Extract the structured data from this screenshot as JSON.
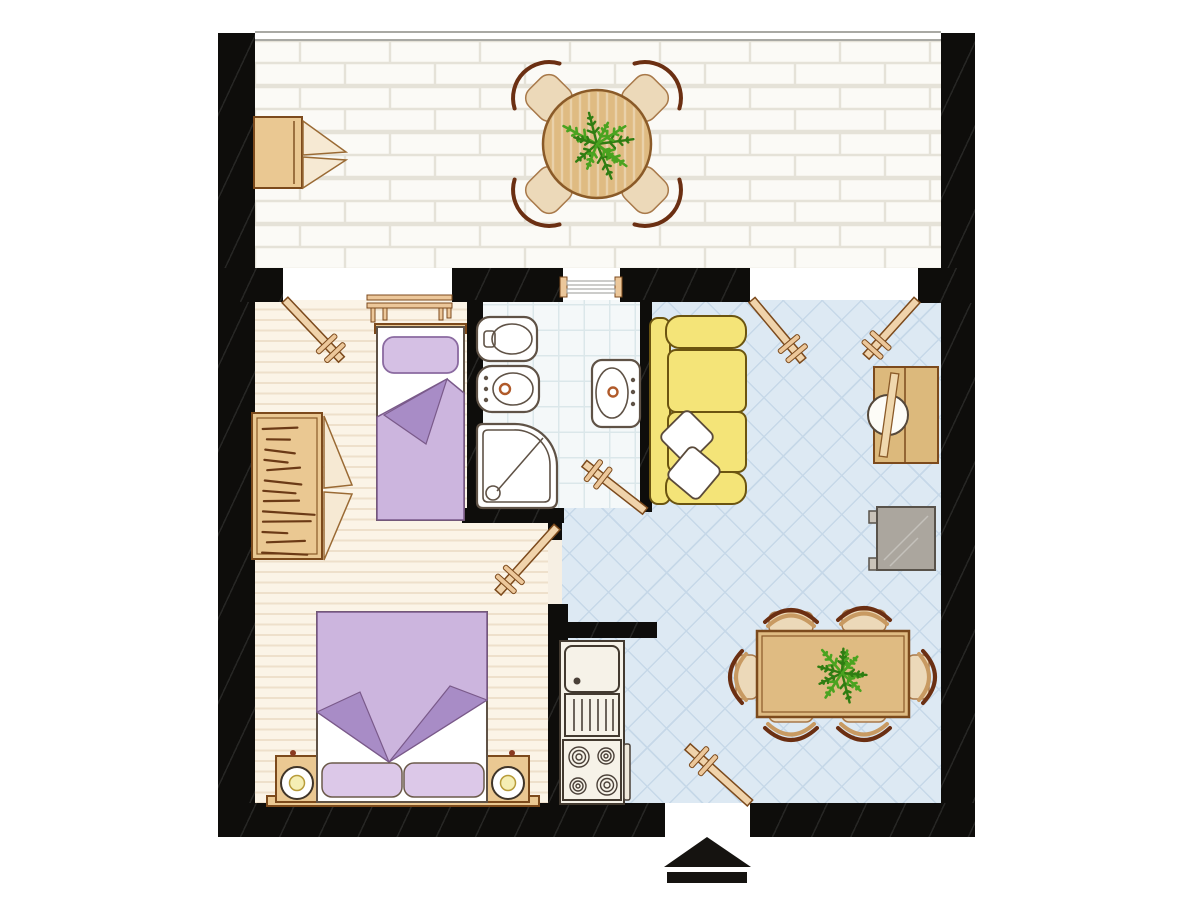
{
  "canvas": {
    "width": 1200,
    "height": 900
  },
  "diagram_type": "apartment-floor-plan",
  "colors": {
    "wall": "#0e0d0b",
    "terrace-floor": "#fbfaf6",
    "terrace-line": "#e5e2d8",
    "bedroom-floor": "#fbf4e7",
    "bedroom-stripe": "#eee0cb",
    "bath-floor": "#f4f8f9",
    "bath-line": "#dbe7ea",
    "living-floor": "#dde9f3",
    "living-line": "#c6d8e8",
    "wood": "#eac892",
    "wood-dark": "#7c4a1c",
    "table-wood": "#dfbb82",
    "chair-seat": "#ecd9b9",
    "chair-back": "#6b2f12",
    "sofa": "#f4e478",
    "sofa-line": "#6b5410",
    "purple": "#ccb5de",
    "purple-light": "#d5c0e4",
    "purple-dark": "#a88cc6",
    "fixture-line": "#5f5246",
    "plant-green": "#4aa320",
    "plant-green-dark": "#2f7d12",
    "gray-tv": "#aba69e",
    "lamp-yellow": "#f5eeb4",
    "accent-orange": "#b05a2a"
  },
  "rooms": [
    {
      "name": "terrace",
      "floor_pattern": "white-brick-tiles",
      "furniture": [
        "storage-cabinet",
        "round-table",
        "four-diagonal-chairs",
        "potted-plant"
      ]
    },
    {
      "name": "bedroom",
      "floor_pattern": "cream-plank-stripes",
      "furniture": [
        "wardrobe-with-hanging-clothes",
        "single-bed",
        "double-bed",
        "nightstand-left",
        "nightstand-right",
        "table-lamp-left",
        "table-lamp-right"
      ]
    },
    {
      "name": "bathroom",
      "floor_pattern": "light-grid-tiles",
      "furniture": [
        "toilet",
        "bidet",
        "corner-shower",
        "washbasin"
      ]
    },
    {
      "name": "living-room",
      "floor_pattern": "blue-diagonal-tiles",
      "furniture": [
        "sofa",
        "two-throw-pillows",
        "desk",
        "desk-chair",
        "tv-unit",
        "dining-table",
        "six-chairs",
        "potted-plant"
      ]
    },
    {
      "name": "kitchen-niche",
      "floor_pattern": "blue-diagonal-tiles",
      "furniture": [
        "refrigerator",
        "vented-cabinet",
        "stove-four-burners"
      ]
    }
  ],
  "doors": [
    {
      "id": "door-terrace-bedroom"
    },
    {
      "id": "door-terrace-living-left"
    },
    {
      "id": "door-terrace-living-right"
    },
    {
      "id": "door-bedroom"
    },
    {
      "id": "door-bathroom"
    },
    {
      "id": "door-entrance"
    }
  ],
  "windows": [
    {
      "id": "bedroom-window"
    },
    {
      "id": "bathroom-window"
    }
  ],
  "markers": {
    "entrance_arrow": "triangle-up-with-bar"
  },
  "plants": [
    {
      "id": "terrace-table-plant",
      "x": 597,
      "y": 144,
      "leaves": 11,
      "size": 38
    },
    {
      "id": "dining-table-plant",
      "x": 842,
      "y": 673,
      "leaves": 11,
      "size": 33
    }
  ],
  "wardrobe_lines": {
    "count": 13,
    "x_min": 262,
    "x_max": 316,
    "y_start": 429,
    "y_step": 10.3
  }
}
